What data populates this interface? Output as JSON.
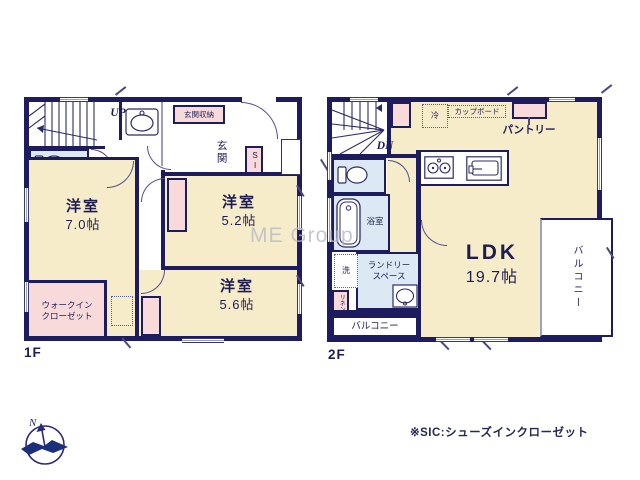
{
  "watermark": "ME Group",
  "footnote": "※SIC:シューズインクローゼット",
  "compass": {
    "north": "N"
  },
  "colors": {
    "wall": "#1c1c5e",
    "room_fill": "#f7ecca",
    "wet_fill": "#dce9f5",
    "closet_fill": "#f8dada"
  },
  "floor1": {
    "label": "1F",
    "stairs": "UP",
    "entrance": "玄関",
    "entrance_storage": "玄関収納",
    "sic": "SIC",
    "room7": {
      "name": "洋室",
      "size": "7.0帖"
    },
    "room52": {
      "name": "洋室",
      "size": "5.2帖"
    },
    "room56": {
      "name": "洋室",
      "size": "5.6帖"
    },
    "wic": {
      "line1": "ウォークイン",
      "line2": "クローゼット"
    }
  },
  "floor2": {
    "label": "2F",
    "stairs": "DN",
    "fridge": "冷",
    "cupboard": "カップボード",
    "pantry": "パントリー",
    "bath": "浴室",
    "washer": "洗",
    "laundry": {
      "line1": "ランドリー",
      "line2": "スペース"
    },
    "linen": "リネン庫",
    "balcony_rear": "バルコニー",
    "balcony_side": "バルコニー",
    "ldk": {
      "name": "LDK",
      "size": "19.7帖"
    }
  }
}
